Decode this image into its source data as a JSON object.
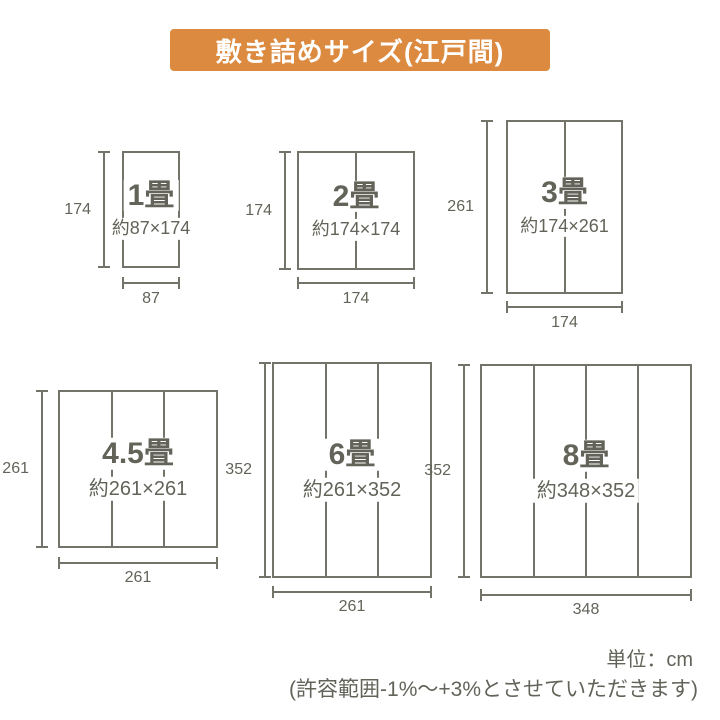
{
  "title": "敷き詰めサイズ(江戸間)",
  "unit_note": "単位：cm",
  "tolerance_note": "(許容範囲-1%～+3%とさせていただきます)",
  "colors": {
    "accent": "#DC8A40",
    "line": "#73736A",
    "text": "#63635A",
    "background": "#FFFFFF"
  },
  "diagrams": [
    {
      "name": "1畳",
      "size": "約87×174",
      "height_cm": "174",
      "width_cm": "87",
      "mats_columns": 1
    },
    {
      "name": "2畳",
      "size": "約174×174",
      "height_cm": "174",
      "width_cm": "174",
      "mats_columns": 2
    },
    {
      "name": "3畳",
      "size": "約174×261",
      "height_cm": "261",
      "width_cm": "174",
      "mats_columns": 2
    },
    {
      "name": "4.5畳",
      "size": "約261×261",
      "height_cm": "261",
      "width_cm": "261",
      "mats_columns": 3
    },
    {
      "name": "6畳",
      "size": "約261×352",
      "height_cm": "352",
      "width_cm": "261",
      "mats_columns": 3
    },
    {
      "name": "8畳",
      "size": "約348×352",
      "height_cm": "352",
      "width_cm": "348",
      "mats_columns": 4
    }
  ]
}
